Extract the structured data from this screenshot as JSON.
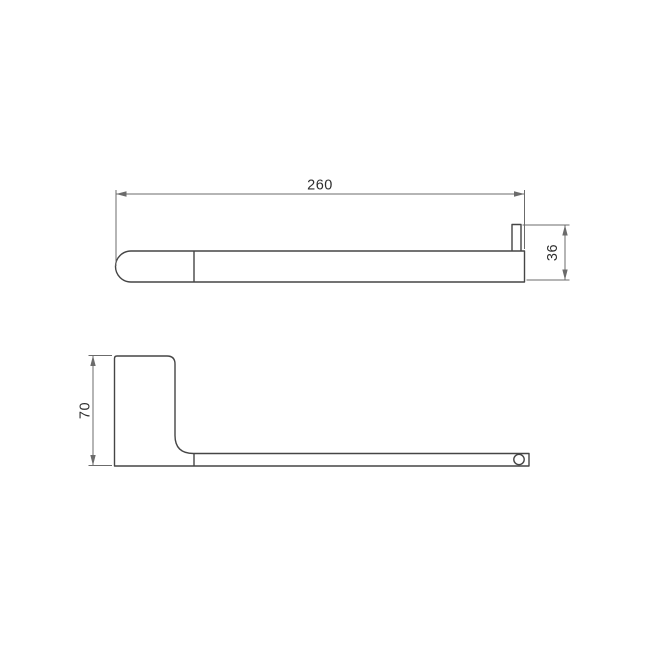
{
  "drawing": {
    "type": "technical-dimension-drawing",
    "subject": "towel-bar-two-view-drawing",
    "background_color": "#ffffff",
    "outline_color": "#454545",
    "dimension_line_color": "#6b6b6b",
    "text_color": "#2e2e2e",
    "top_view": {
      "length_dimension": "260",
      "height_dimension": "36"
    },
    "side_view": {
      "height_dimension": "70"
    }
  }
}
